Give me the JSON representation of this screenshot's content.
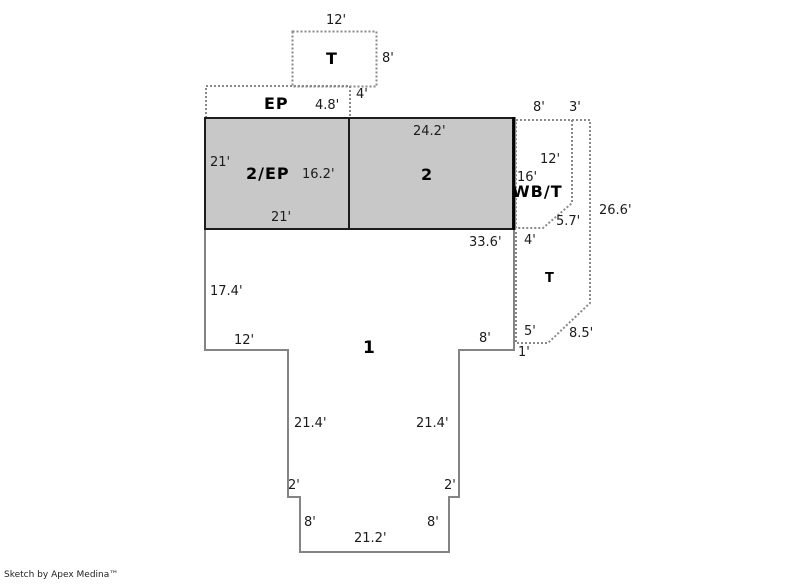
{
  "credit": "Sketch by Apex Medina™",
  "colors": {
    "room_fill": "#c8c8c8",
    "solid_outline": "#848484",
    "dotted_outline": "#8a8a8a",
    "dark_border": "#1c1c1c"
  },
  "rooms": {
    "t_upper": "T",
    "ep": "EP",
    "two_ep": "2/EP",
    "two": "2",
    "wb_t": "WB/T",
    "one": "1",
    "t_right": "T"
  },
  "dims": {
    "t_top_width": "12'",
    "t_height": "8'",
    "ep_depth": "4.8'",
    "ep_right": "4'",
    "wb_top_8": "8'",
    "wb_top_3": "3'",
    "two_ep_left": "21'",
    "two_ep_height": "16.2'",
    "two_ep_bottom": "21'",
    "two_top": "24.2'",
    "wb_12": "12'",
    "wb_16": "16'",
    "wb_57": "5.7'",
    "right_266": "26.6'",
    "one_top": "33.6'",
    "t_4": "4'",
    "one_left": "17.4'",
    "one_left_bottom": "12'",
    "one_right_8": "8'",
    "t_5": "5'",
    "t_1": "1'",
    "t_85": "8.5'",
    "left_214": "21.4'",
    "right_214": "21.4'",
    "left_2": "2'",
    "right_2": "2'",
    "bottom_left_8": "8'",
    "bottom_right_8": "8'",
    "bottom_212": "21.2'"
  }
}
